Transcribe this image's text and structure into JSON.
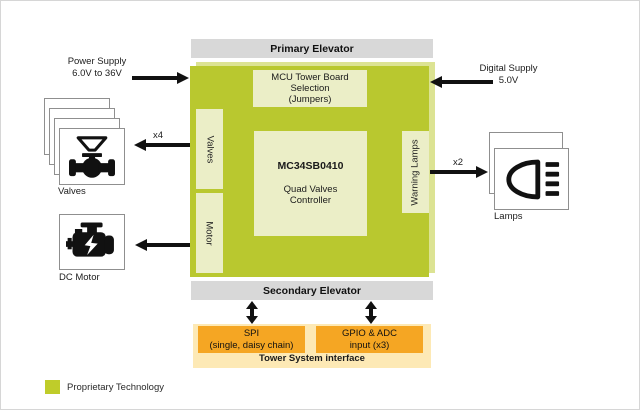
{
  "diagram": {
    "title_bars": {
      "primary": "Primary Elevator",
      "secondary": "Secondary Elevator"
    },
    "board": {
      "mcu_line1": "MCU Tower Board",
      "mcu_line2": "Selection",
      "mcu_line3": "(Jumpers)",
      "part_number": "MC34SB0410",
      "part_desc_line1": "Quad Valves",
      "part_desc_line2": "Controller",
      "valves_port": "Valves",
      "motor_port": "Motor",
      "lamps_port": "Warning Lamps"
    },
    "left": {
      "power_line1": "Power Supply",
      "power_line2": "6.0V to 36V",
      "valves_count": "x4",
      "valves_label": "Valves",
      "motor_label": "DC Motor"
    },
    "right": {
      "digital_line1": "Digital Supply",
      "digital_line2": "5.0V",
      "lamps_count": "x2",
      "lamps_label": "Lamps"
    },
    "tower": {
      "spi_line1": "SPI",
      "spi_line2": "(single, daisy chain)",
      "gpio_line1": "GPIO & ADC",
      "gpio_line2": "input (x3)",
      "caption": "Tower System interface"
    },
    "legend": {
      "label": "Proprietary Technology"
    },
    "colors": {
      "board_green": "#b9c82f",
      "board_shadow_green": "#dce393",
      "inner_box_green": "#ebeec7",
      "elevator_gray": "#d8d8d8",
      "interface_orange": "#f5a623",
      "interface_cream": "#fde9b5"
    }
  }
}
